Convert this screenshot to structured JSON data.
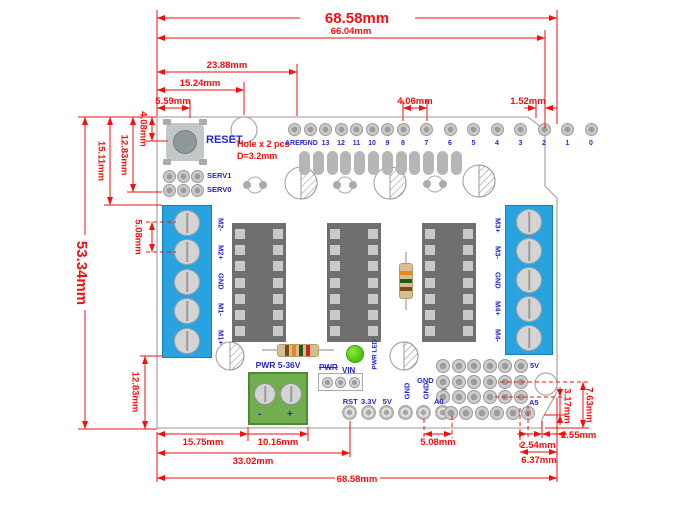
{
  "colors": {
    "dimension_red": "#F40F0F",
    "label_blue": "#2727CE",
    "board_outline": "#ADADAD",
    "terminal_blue": "#29A3E0",
    "terminal_green": "#72AD50",
    "led_green": "#49C40A"
  },
  "dims": {
    "top": {
      "board_width": "68.58mm",
      "inner_width": "66.04mm",
      "hole2_offset": "23.88mm",
      "hole_center": "15.24mm",
      "reset_offset": "5.59mm",
      "header_gap": "4.06mm",
      "pin0_to_edge": "1.52mm"
    },
    "left": {
      "board_height": "53.34mm",
      "terminal_top": "15.11mm",
      "serv_row": "12.83mm",
      "reset_center": "4.08mm",
      "screw_pitch": "5.08mm",
      "terminal_bottom": "12.83mm"
    },
    "bottom": {
      "pwr_left": "15.75mm",
      "pwr_width": "10.16mm",
      "rst_offset": "33.02mm",
      "board_width": "68.58mm",
      "pin_pitch": "5.08mm",
      "pad_pitch": "2.54mm",
      "edge_step": "2.55mm",
      "notch_width": "6.37mm"
    },
    "right": {
      "notch_height": "3.17mm",
      "bottom_height": "7.63mm"
    }
  },
  "board": {
    "reset_label": "RESET",
    "hole_note": [
      "Hole x 2 pcs",
      "D=3.2mm"
    ],
    "top_pins": [
      "AREF",
      "GND",
      "13",
      "12",
      "11",
      "10",
      "9",
      "8",
      "7",
      "6",
      "5",
      "4",
      "3",
      "2",
      "1",
      "0"
    ],
    "servo_labels": [
      "SERV1",
      "SERV0"
    ],
    "terminal_left_pins": [
      "M2-",
      "M2+",
      "GND",
      "M1-",
      "M1+"
    ],
    "terminal_right_pins": [
      "M3+",
      "M3-",
      "GND",
      "M4+",
      "M4-"
    ],
    "power_terminal": {
      "label": "PWR 5-36V",
      "minus": "-",
      "plus": "+"
    },
    "power_header": {
      "left": "PWR",
      "right": "VIN"
    },
    "led_label": "PWR LED",
    "bottom_pins_h": [
      "RST",
      "3.3V",
      "5V"
    ],
    "bottom_pins_v": [
      "GND",
      "GND",
      "VIN"
    ],
    "grid_labels": {
      "gnd": "GND",
      "v5": "5V",
      "a0": "A0",
      "a5": "A5"
    }
  }
}
